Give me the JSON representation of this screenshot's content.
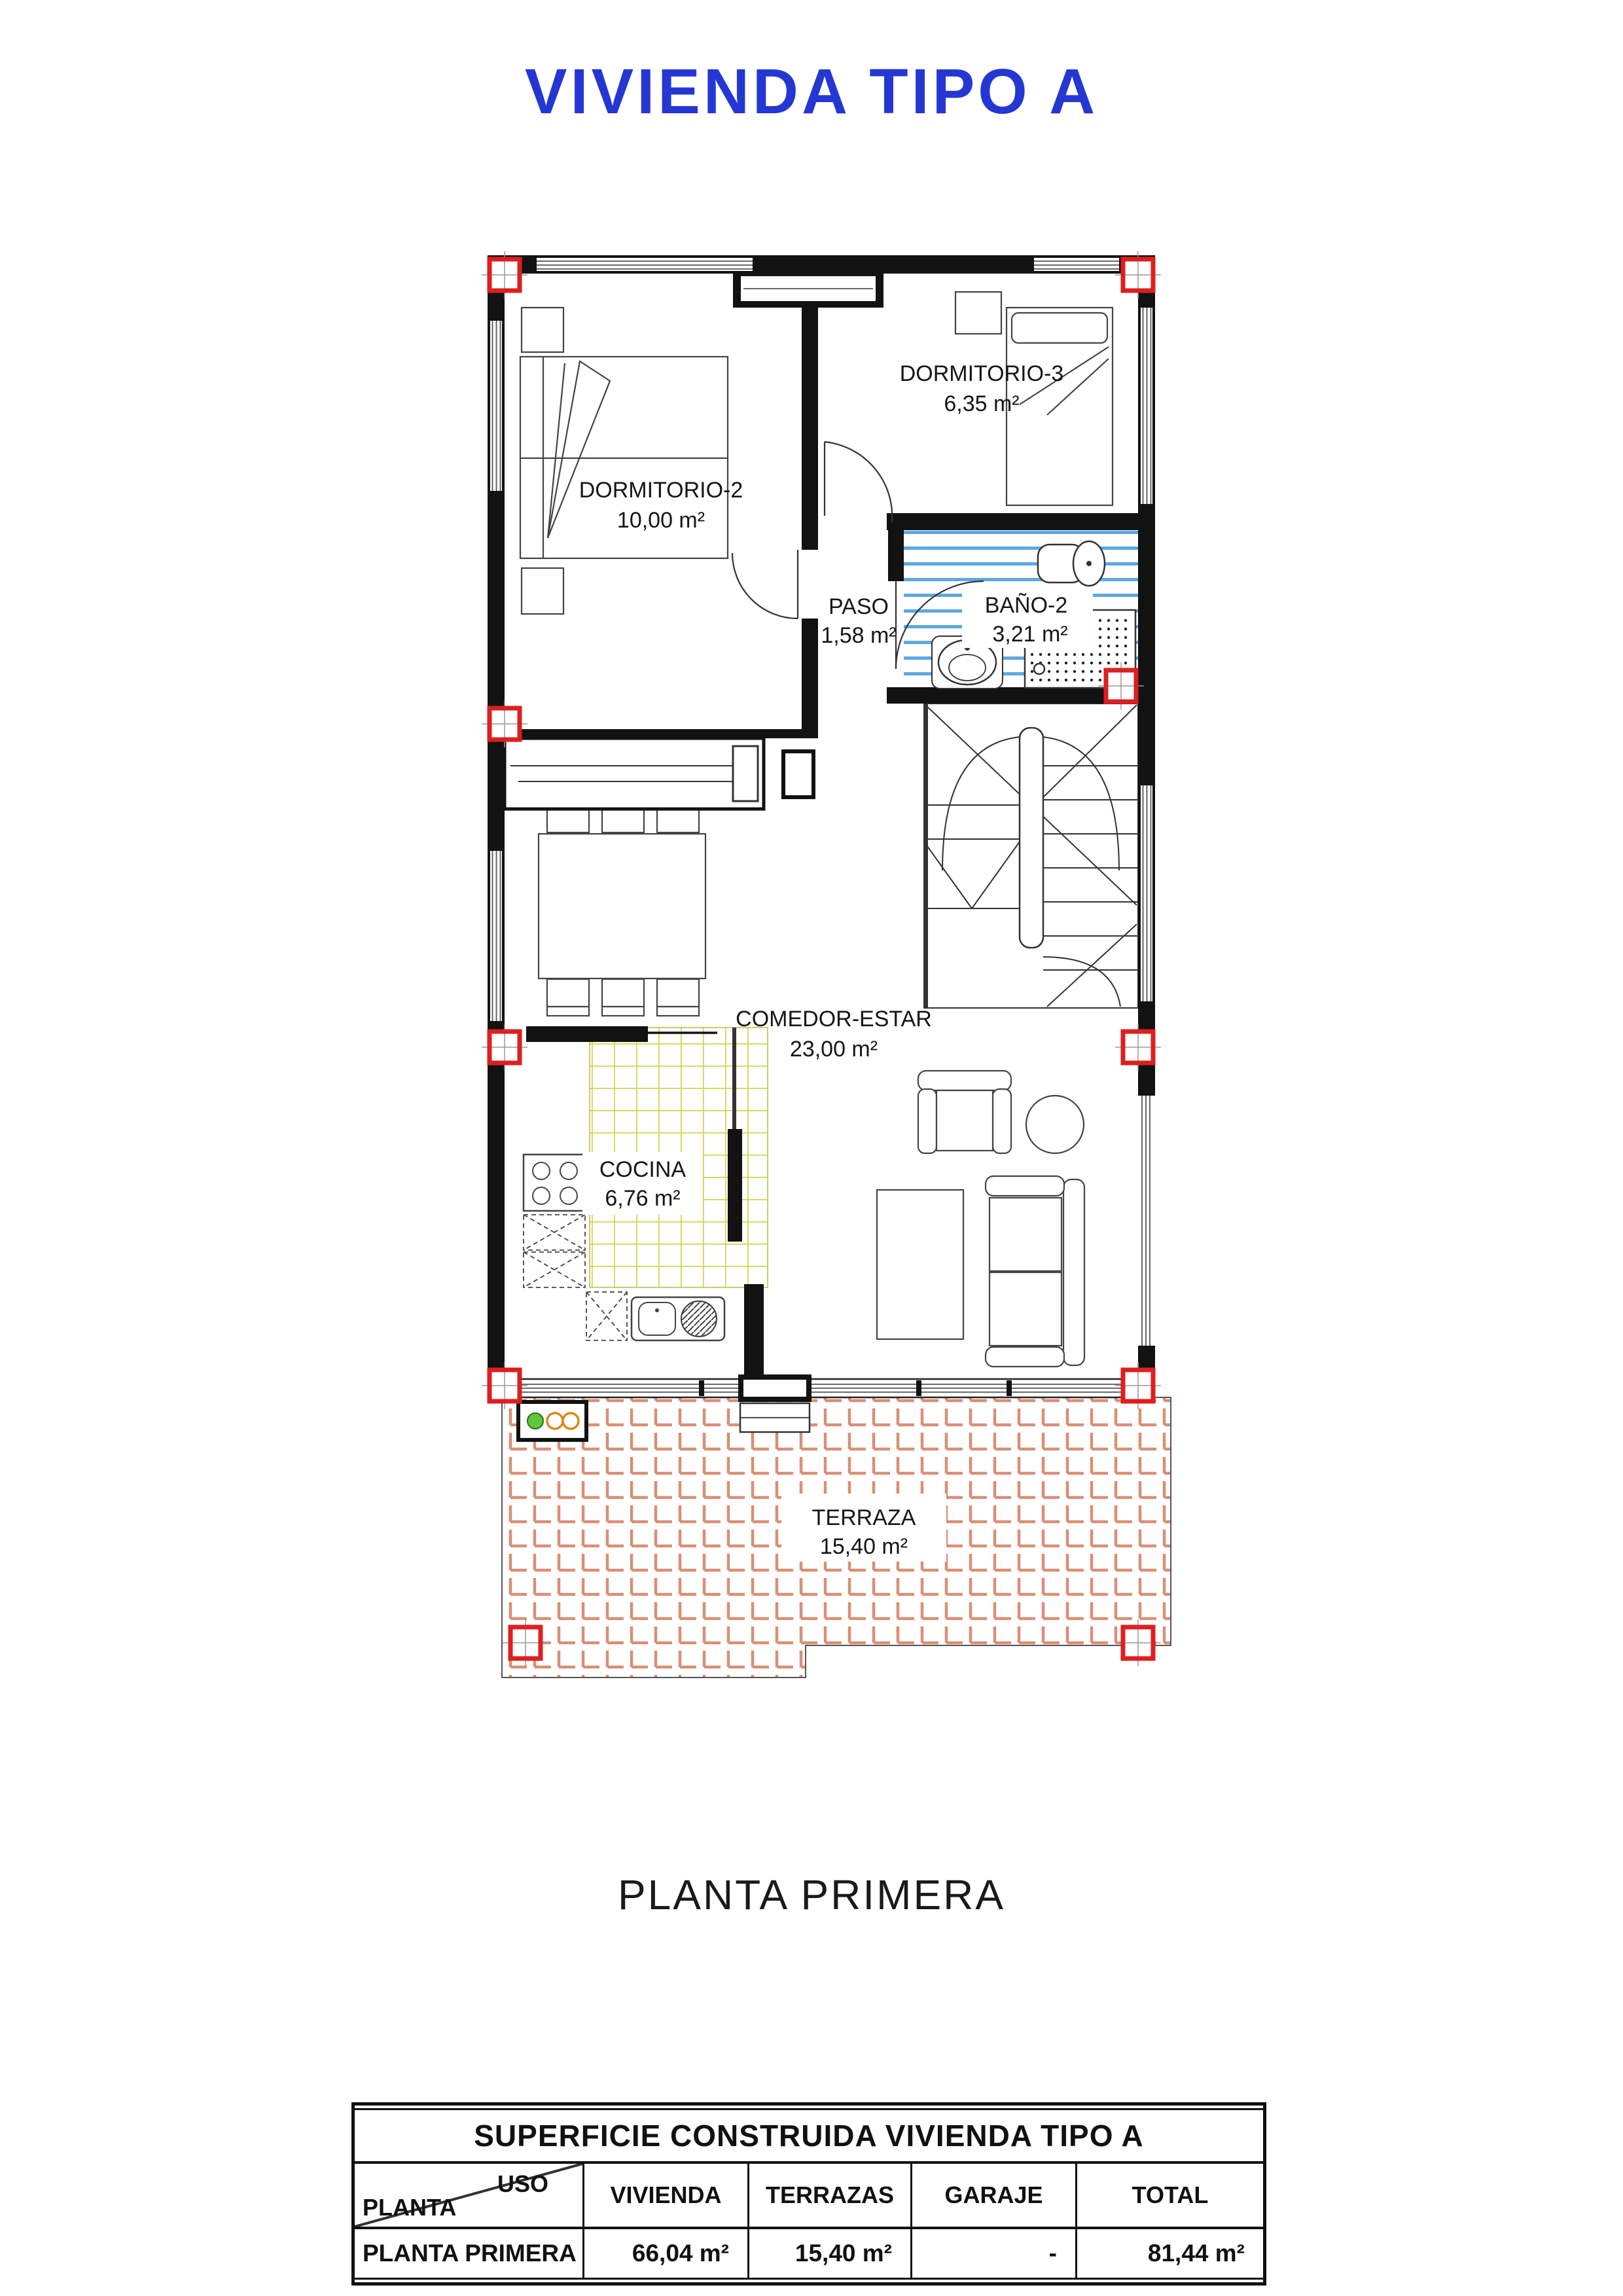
{
  "title": "VIVIENDA TIPO A",
  "caption": "PLANTA PRIMERA",
  "colors": {
    "title_blue": "#2437d4",
    "column_red": "#dd1f1f",
    "terrace_tile_orange": "#d98f75",
    "kitchen_tile_yellow": "#d2d64f",
    "bath_tile_blue": "#5ba9e2",
    "boiler_green": "#5fc83c",
    "boiler_orange": "#d98a1e"
  },
  "plan": {
    "rooms": [
      {
        "name": "DORMITORIO-2",
        "area": "10,00 m²"
      },
      {
        "name": "DORMITORIO-3",
        "area": "6,35 m²"
      },
      {
        "name": "PASO",
        "area": "1,58 m²"
      },
      {
        "name": "BAÑO-2",
        "area": "3,21 m²"
      },
      {
        "name": "COMEDOR-ESTAR",
        "area": "23,00 m²"
      },
      {
        "name": "COCINA",
        "area": "6,76 m²"
      },
      {
        "name": "TERRAZA",
        "area": "15,40 m²"
      }
    ]
  },
  "table": {
    "title": "SUPERFICIE CONSTRUIDA VIVIENDA TIPO A",
    "corner": {
      "top": "USO",
      "bottom": "PLANTA"
    },
    "columns": [
      "VIVIENDA",
      "TERRAZAS",
      "GARAJE",
      "TOTAL"
    ],
    "rows": [
      {
        "label": "PLANTA PRIMERA",
        "values": [
          "66,04 m²",
          "15,40 m²",
          "-",
          "81,44 m²"
        ]
      }
    ]
  }
}
